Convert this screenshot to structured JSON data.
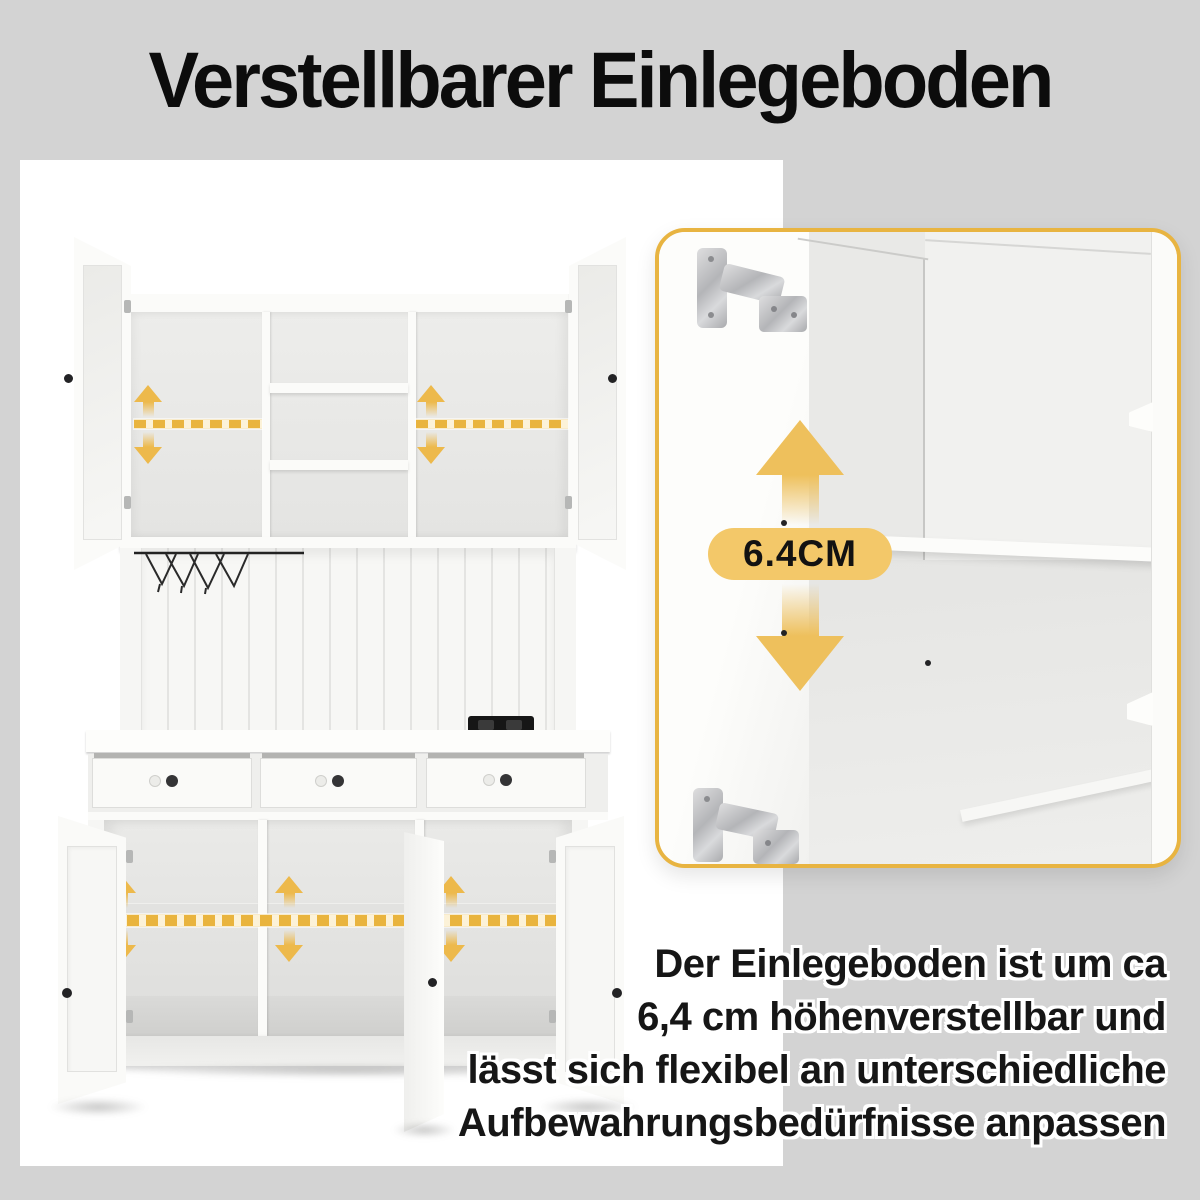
{
  "title": {
    "text": "Verstellbarer Einlegeboden"
  },
  "detail_card": {
    "badge": "6.4CM"
  },
  "description": {
    "lines": [
      "Der Einlegeboden ist um ca",
      "6,4 cm höhenverstellbar und",
      "lässt sich flexibel an unterschiedliche",
      "Aufbewahrungsbedürfnisse anpassen"
    ]
  },
  "colors": {
    "background": "#d3d3d3",
    "panel": "#ffffff",
    "card_border_gold": "#e8b441",
    "badge_background": "#f3c869",
    "arrow_yellow": "#edb94b",
    "dash_yellow": "#e9b43e",
    "text_black": "#121212"
  },
  "icons": {
    "up_arrow": "arrow-up-icon",
    "down_arrow": "arrow-down-icon",
    "hinge": "cabinet-hinge-icon",
    "wine_rack": "stemware-rack-icon"
  }
}
